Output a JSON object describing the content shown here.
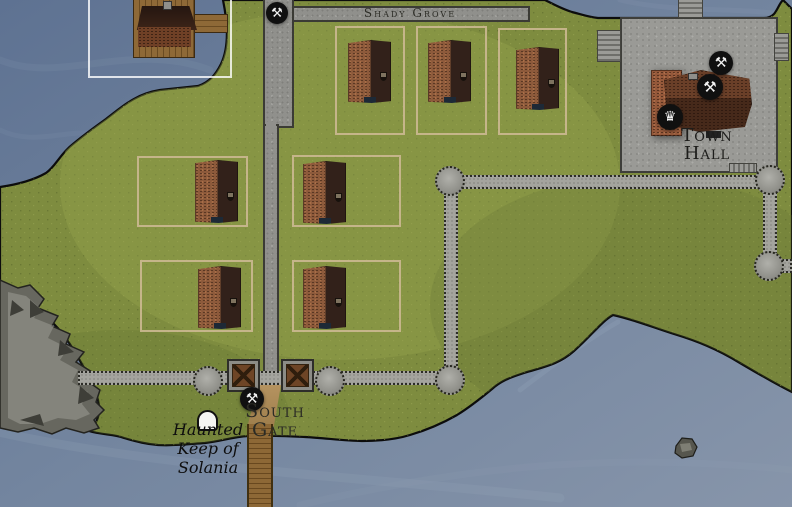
{
  "map_title": "Walled town map",
  "labels": {
    "street": "Shady Grove",
    "town_hall": [
      "Town",
      "Hall"
    ],
    "south_gate": [
      "South",
      "Gate"
    ],
    "haunted_keep": [
      "Haunted",
      "Keep of",
      "Solania"
    ]
  },
  "markers": {
    "hammer_glyph": "⚒",
    "crown_glyph": "♛"
  },
  "colors": {
    "water": "#6e819c",
    "grass": "#7e8c3f",
    "road": "#90908c",
    "plaza": "#9a9a96",
    "wall": "#a4a49e",
    "building_brick": "#8d5a3b",
    "building_roof_dark": "#32211a",
    "plot_outline": "#d0bb96",
    "marker_background": "#101010",
    "rock": "#66665f",
    "wood": "#8d6836"
  }
}
